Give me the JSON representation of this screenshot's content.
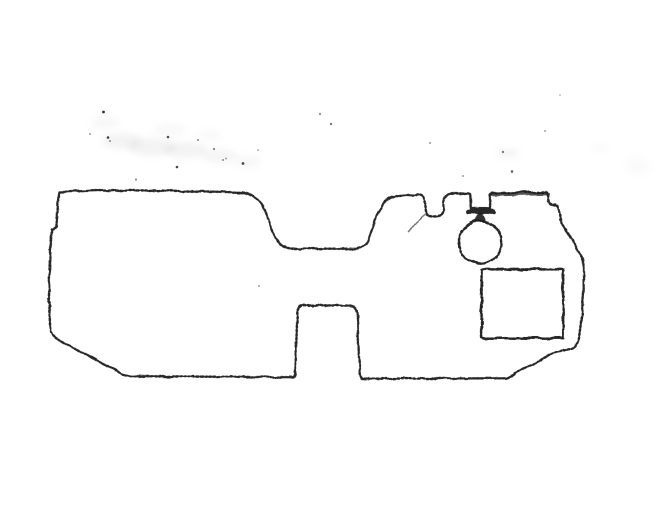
{
  "canvas": {
    "width": 656,
    "height": 524,
    "background_color": "#ffffff",
    "ink_color": "#1c1c1c",
    "smudge_color": "#8a8a8a"
  },
  "figure": {
    "type": "scanned-line-drawing",
    "title": "irregular flat part outline with circular grommet marker and rectangular inset",
    "outline": {
      "path": "M 59.2 192 L 96 190.6 L 150 190.4 L 200 191.3 L 241 192.4 C 252 193.1 259.5 199.5 264.5 210 C 269.5 220.5 272.5 235.5 280 244 C 283.2 247.3 287.5 248.4 292 248.5 L 355 248.8 C 361.5 248.8 366 244.4 369 237.4 C 373.5 227 377 210.5 385.5 201 C 388.2 198.1 391.6 196.3 395.6 195.7 L 418 194.4 C 422.2 194.2 424.3 196.6 424.6 201.4 L 425.2 208.8 C 425.5 213.6 427.6 216.2 431.6 216.4 L 436.8 216.5 C 440.8 216.5 443 214 443.4 209.2 L 444 201.2 C 444.4 196.6 446.6 194 450.6 193.8 L 467.5 193.3 L 470.3 194.3 L 470.8 208.4 L 490 208.7 L 490.6 194.2 L 493.2 193 L 546.6 192.4 L 548.2 198.4 C 548.7 202.8 550.3 204.4 553.2 204.7 L 556 205.1 C 557.7 205.4 558.5 207.3 558.8 210.6 L 559.4 215.8 C 560.2 222.2 562.8 226.4 566.6 231.4 C 571.6 238 575.4 245.2 578.2 251.4 C 580.3 255.7 582.1 257.9 583.4 260.6 L 583.7 290 L 581.3 320 L 578.7 340.4 C 577.3 345.2 574.6 347.9 569.9 348.9 L 553.8 352.9 L 506.8 378.3 L 362 378.7 L 359.7 374.6 L 357.3 314.8 C 357.1 308.6 354.7 305.7 349.7 305.6 L 304.5 305.2 C 299.7 305.2 297.5 308.3 297.3 313.8 L 295.3 373.4 C 295.2 376.1 294.1 377.2 291.5 377.2 L 131 376.2 C 127 376.1 124 375.2 121 373.7 L 57.3 339.2 C 52.9 336.6 50.7 334 50.3 329.6 L 48.9 300 L 49.7 262 L 51.7 229.4 L 56.3 227.2 L 57.5 212 L 58.4 195.4 C 58.5 193.4 58.8 192.4 59.2 192 Z"
    },
    "notch_bar": {
      "path": "M 468.3 211.6 L 493.6 211.6"
    },
    "top_retrace": {
      "path": "M 491.5 194.8 L 548 193.8"
    },
    "scratch": {
      "path": "M 408 232 Q 416.5 222.5 424.5 214.5"
    },
    "connector_stem": {
      "path": "M 478.9 212.8 L 482.4 212.8 L 486.6 221.8 L 474.8 221.8 Z"
    },
    "grommet_circle": {
      "cx": 480.2,
      "cy": 242.3,
      "r": 21.4
    },
    "inset_rectangle": {
      "x": 481.6,
      "y": 269.4,
      "width": 81.6,
      "height": 68.8
    }
  },
  "artifacts": {
    "smudges": [
      {
        "cx": 105,
        "cy": 123,
        "rx": 14,
        "ry": 6,
        "opacity": 0.07
      },
      {
        "cx": 122,
        "cy": 141,
        "rx": 20,
        "ry": 8,
        "opacity": 0.1
      },
      {
        "cx": 152,
        "cy": 147,
        "rx": 24,
        "ry": 9,
        "opacity": 0.1
      },
      {
        "cx": 186,
        "cy": 150,
        "rx": 22,
        "ry": 8,
        "opacity": 0.09
      },
      {
        "cx": 220,
        "cy": 156,
        "rx": 18,
        "ry": 7,
        "opacity": 0.08
      },
      {
        "cx": 248,
        "cy": 162,
        "rx": 13,
        "ry": 6,
        "opacity": 0.07
      },
      {
        "cx": 170,
        "cy": 130,
        "rx": 16,
        "ry": 6,
        "opacity": 0.06
      },
      {
        "cx": 210,
        "cy": 135,
        "rx": 12,
        "ry": 5,
        "opacity": 0.05
      },
      {
        "cx": 508,
        "cy": 153,
        "rx": 11,
        "ry": 4,
        "opacity": 0.1
      },
      {
        "cx": 638,
        "cy": 166,
        "rx": 12,
        "ry": 8,
        "opacity": 0.04
      },
      {
        "cx": 600,
        "cy": 148,
        "rx": 9,
        "ry": 4,
        "opacity": 0.03
      }
    ],
    "dots": [
      {
        "cx": 103.5,
        "cy": 112,
        "r": 1.4,
        "opacity": 0.9
      },
      {
        "cx": 108,
        "cy": 137.5,
        "r": 1.3,
        "opacity": 0.85
      },
      {
        "cx": 110,
        "cy": 141,
        "r": 1.0,
        "opacity": 0.5
      },
      {
        "cx": 90,
        "cy": 134,
        "r": 1.0,
        "opacity": 0.45
      },
      {
        "cx": 136,
        "cy": 179.5,
        "r": 1.1,
        "opacity": 0.5
      },
      {
        "cx": 168,
        "cy": 137,
        "r": 1.3,
        "opacity": 0.75
      },
      {
        "cx": 177,
        "cy": 167,
        "r": 1.3,
        "opacity": 0.8
      },
      {
        "cx": 198,
        "cy": 140,
        "r": 1.0,
        "opacity": 0.5
      },
      {
        "cx": 214,
        "cy": 149,
        "r": 1.1,
        "opacity": 0.55
      },
      {
        "cx": 223,
        "cy": 160,
        "r": 1.0,
        "opacity": 0.5
      },
      {
        "cx": 226,
        "cy": 158.5,
        "r": 1.0,
        "opacity": 0.4
      },
      {
        "cx": 243,
        "cy": 163.5,
        "r": 1.4,
        "opacity": 0.8
      },
      {
        "cx": 258,
        "cy": 150,
        "r": 1.0,
        "opacity": 0.35
      },
      {
        "cx": 320,
        "cy": 114,
        "r": 1.1,
        "opacity": 0.5
      },
      {
        "cx": 331,
        "cy": 124,
        "r": 1.2,
        "opacity": 0.6
      },
      {
        "cx": 430,
        "cy": 143,
        "r": 1.0,
        "opacity": 0.45
      },
      {
        "cx": 463,
        "cy": 176,
        "r": 1.0,
        "opacity": 0.45
      },
      {
        "cx": 503,
        "cy": 152,
        "r": 1.2,
        "opacity": 0.55
      },
      {
        "cx": 512,
        "cy": 171.5,
        "r": 1.3,
        "opacity": 0.7
      },
      {
        "cx": 545,
        "cy": 131,
        "r": 1.0,
        "opacity": 0.4
      },
      {
        "cx": 259,
        "cy": 286,
        "r": 1.0,
        "opacity": 0.4
      },
      {
        "cx": 560,
        "cy": 95,
        "r": 0.9,
        "opacity": 0.35
      }
    ]
  }
}
